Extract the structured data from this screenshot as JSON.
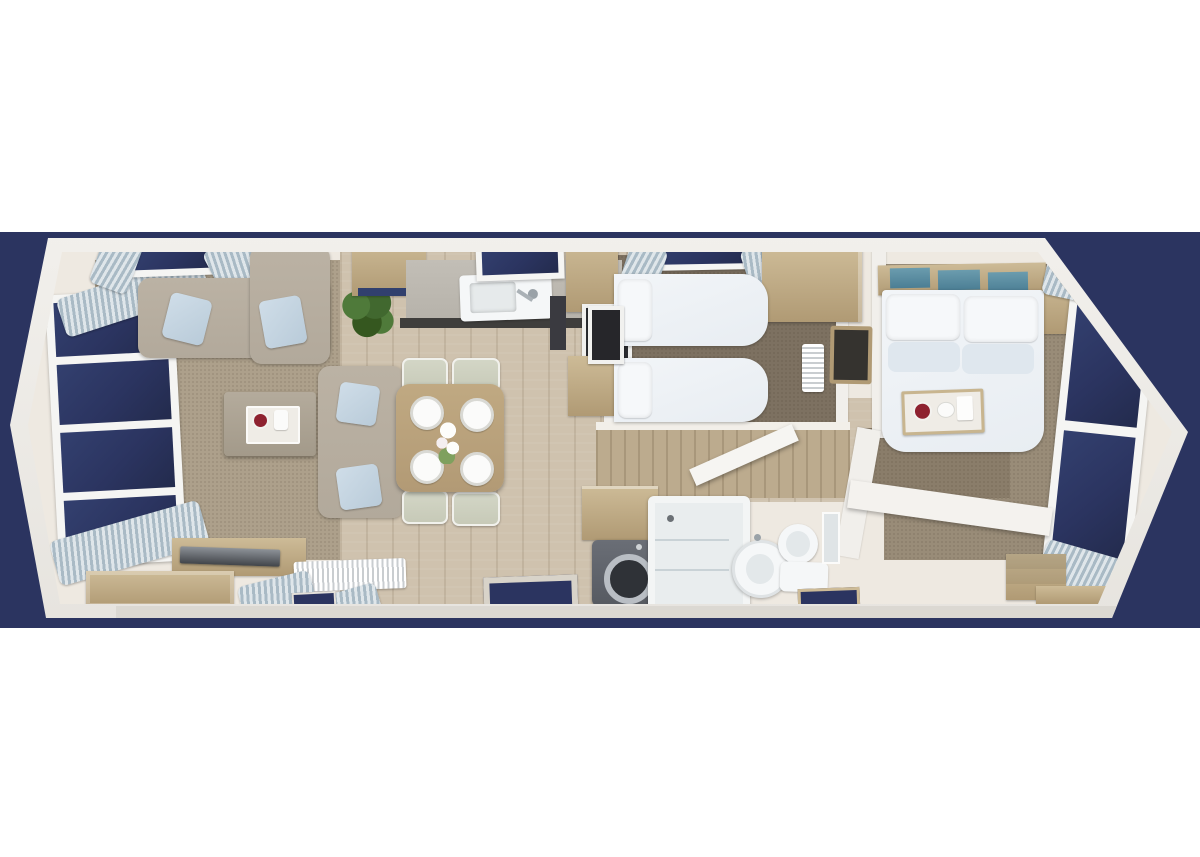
{
  "meta": {
    "description": "3D top-down floor plan render of a two-bedroom holiday static caravan on a navy backdrop",
    "image_type": "3d-floorplan-render",
    "visible_text": "none"
  },
  "colors": {
    "page": "#ffffff",
    "navy": "#2b3460",
    "wallLight": "#f1efeb",
    "wallShade": "#e0ddd7",
    "floorIvory": "#eee9e1",
    "floorWood": "#cfc2ae",
    "carpetLiving": "#ada08b",
    "carpetDark": "#7d7161",
    "carpetMaster": "#998c78",
    "wood": "#cdbb97",
    "woodDark": "#b09a74",
    "sofa": "#b2a99b",
    "cushion": "#b9cbd9",
    "fixture": "#f5f7f8",
    "worktop": "#b6b2aa",
    "worktopEdge": "#3f3e3c",
    "appliance": "#2c2d31",
    "washer": "#565a61",
    "glassTeal": "#4b7e94",
    "plant": "#41682f",
    "tableWood": "#b29a75",
    "chair": "#c7cab8",
    "duvet": "#e8edf2",
    "pillow": "#f6f8fa",
    "matFrame": "#d8d3c9",
    "curtainA": "#dfe6ea",
    "curtainB": "#a9bac5",
    "trayWood": "#c8b58f",
    "cupRed": "#8e2230"
  },
  "rooms": {
    "living": {
      "label": "Living room — corner sofa, two-seat sofa, coffee table, TV sideboard, bay windows with curtains, radiator, pot plant"
    },
    "dining": {
      "label": "Dining area — wooden table, four place settings, four chairs, flower vase"
    },
    "kitchen": {
      "label": "Kitchen — sink with drainer, worktop, overhead cupboards, built-in oven, tall unit, roof skylight"
    },
    "entry": {
      "label": "Entrance — door mat"
    },
    "utility": {
      "label": "Utility cupboard — washing machine"
    },
    "bathroom": {
      "label": "Family shower room — shower enclosure, pedestal basin, toilet, bath mat"
    },
    "hall": {
      "label": "Hallway — radiator, framed mirror"
    },
    "twin": {
      "label": "Twin bedroom — two single beds, overhead wardrobe, skylight with curtains, wall TV"
    },
    "master": {
      "label": "Master bedroom — double bed with breakfast tray, headboard glass panels, wardrobe, dressing desk, chest of drawers, end window with curtains"
    }
  },
  "counts": {
    "windows": 6,
    "skylights": 2,
    "beds": 3,
    "sofas": 2,
    "doormats": 3
  }
}
